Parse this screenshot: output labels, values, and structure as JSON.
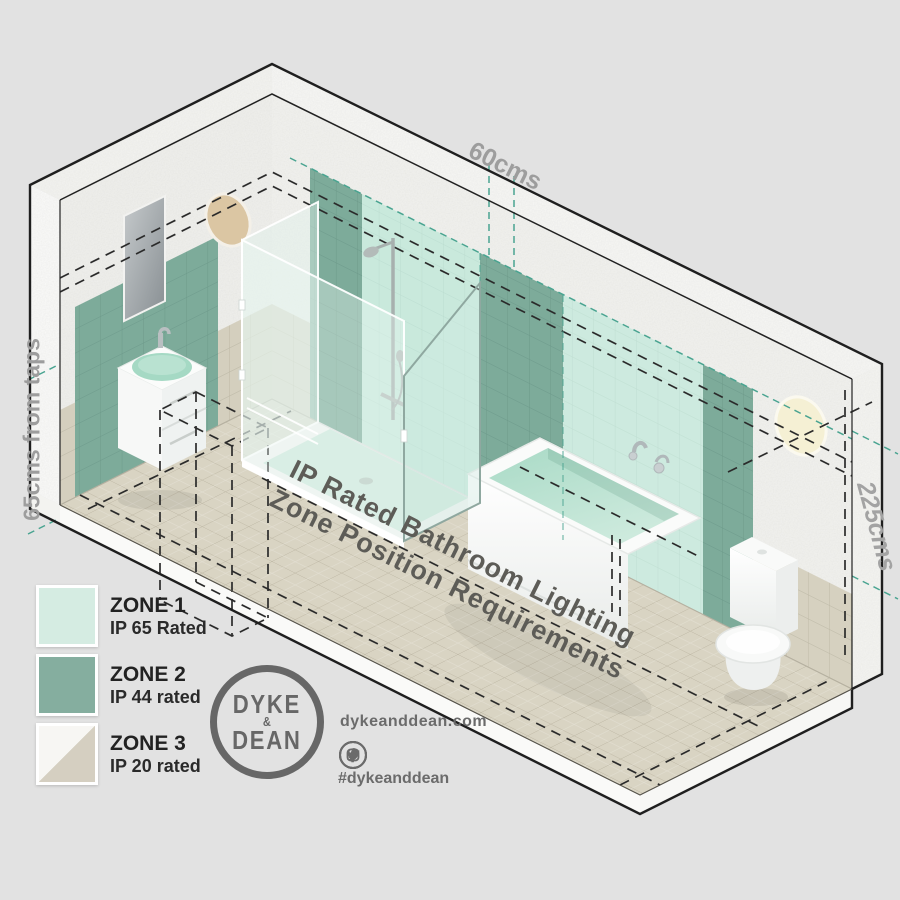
{
  "poster": {
    "floor_title": {
      "line1": "IP Rated Bathroom Lighting",
      "line2": "Zone Position Requirements"
    },
    "dimensions": {
      "top": "60cms",
      "left": "65cms from taps",
      "right": "225cms"
    },
    "legend": {
      "items": [
        {
          "zone": "ZONE 1",
          "rating": "IP 65 Rated",
          "swatch_color": "#d5ece2"
        },
        {
          "zone": "ZONE 2",
          "rating": "IP 44 rated",
          "swatch_color": "#85ae9f"
        },
        {
          "zone": "ZONE 3",
          "rating": "IP 20 rated",
          "swatch_colors": [
            "#f7f6f3",
            "#d5cfc1"
          ]
        }
      ]
    },
    "branding": {
      "logo": {
        "line1": "DYKE",
        "ampersand": "&",
        "line2": "DEAN"
      },
      "website": "dykeanddean.com",
      "hashtag": "#dykeanddean",
      "social": [
        "instagram",
        "twitter",
        "facebook",
        "pinterest"
      ]
    },
    "room_fixtures": [
      "washbasin",
      "shower",
      "bathtub",
      "toilet",
      "mirror",
      "wall-light-left",
      "wall-light-right"
    ],
    "colors": {
      "background": "#e2e2e2",
      "zone1_mint": "#cfe9dd",
      "zone2_green": "#7dab9a",
      "zone3_beige": "#d5cfc1",
      "floor_tile": "#d9d4c3",
      "dashed_black": "#2b2b2b",
      "dashed_teal": "#4aa491",
      "brand_gray": "#6b6b6b",
      "dim_label_gray": "#9d9d9d"
    }
  }
}
